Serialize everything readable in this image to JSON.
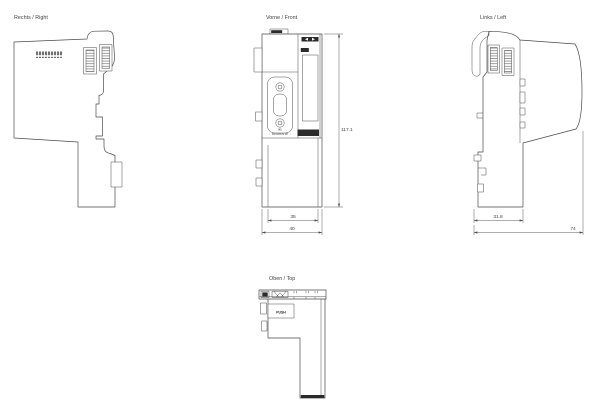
{
  "drawing": {
    "type": "mechanical-dimension-drawing",
    "unit_hint": "mm",
    "views": {
      "right": {
        "title": "Rechts / Right"
      },
      "front": {
        "title": "Vorne / Front",
        "x1_label": "X1",
        "bus_label": "PROFIBUS DP",
        "dim_height": "117.1",
        "dim_width_body": "35",
        "dim_width_total": "40"
      },
      "left": {
        "title": "Links / Left",
        "dim_depth_rail": "31.8",
        "dim_depth_total": "74"
      },
      "top": {
        "title": "Oben / Top",
        "push_label": "PUSH"
      }
    },
    "line_color": "#4a4a4a"
  }
}
